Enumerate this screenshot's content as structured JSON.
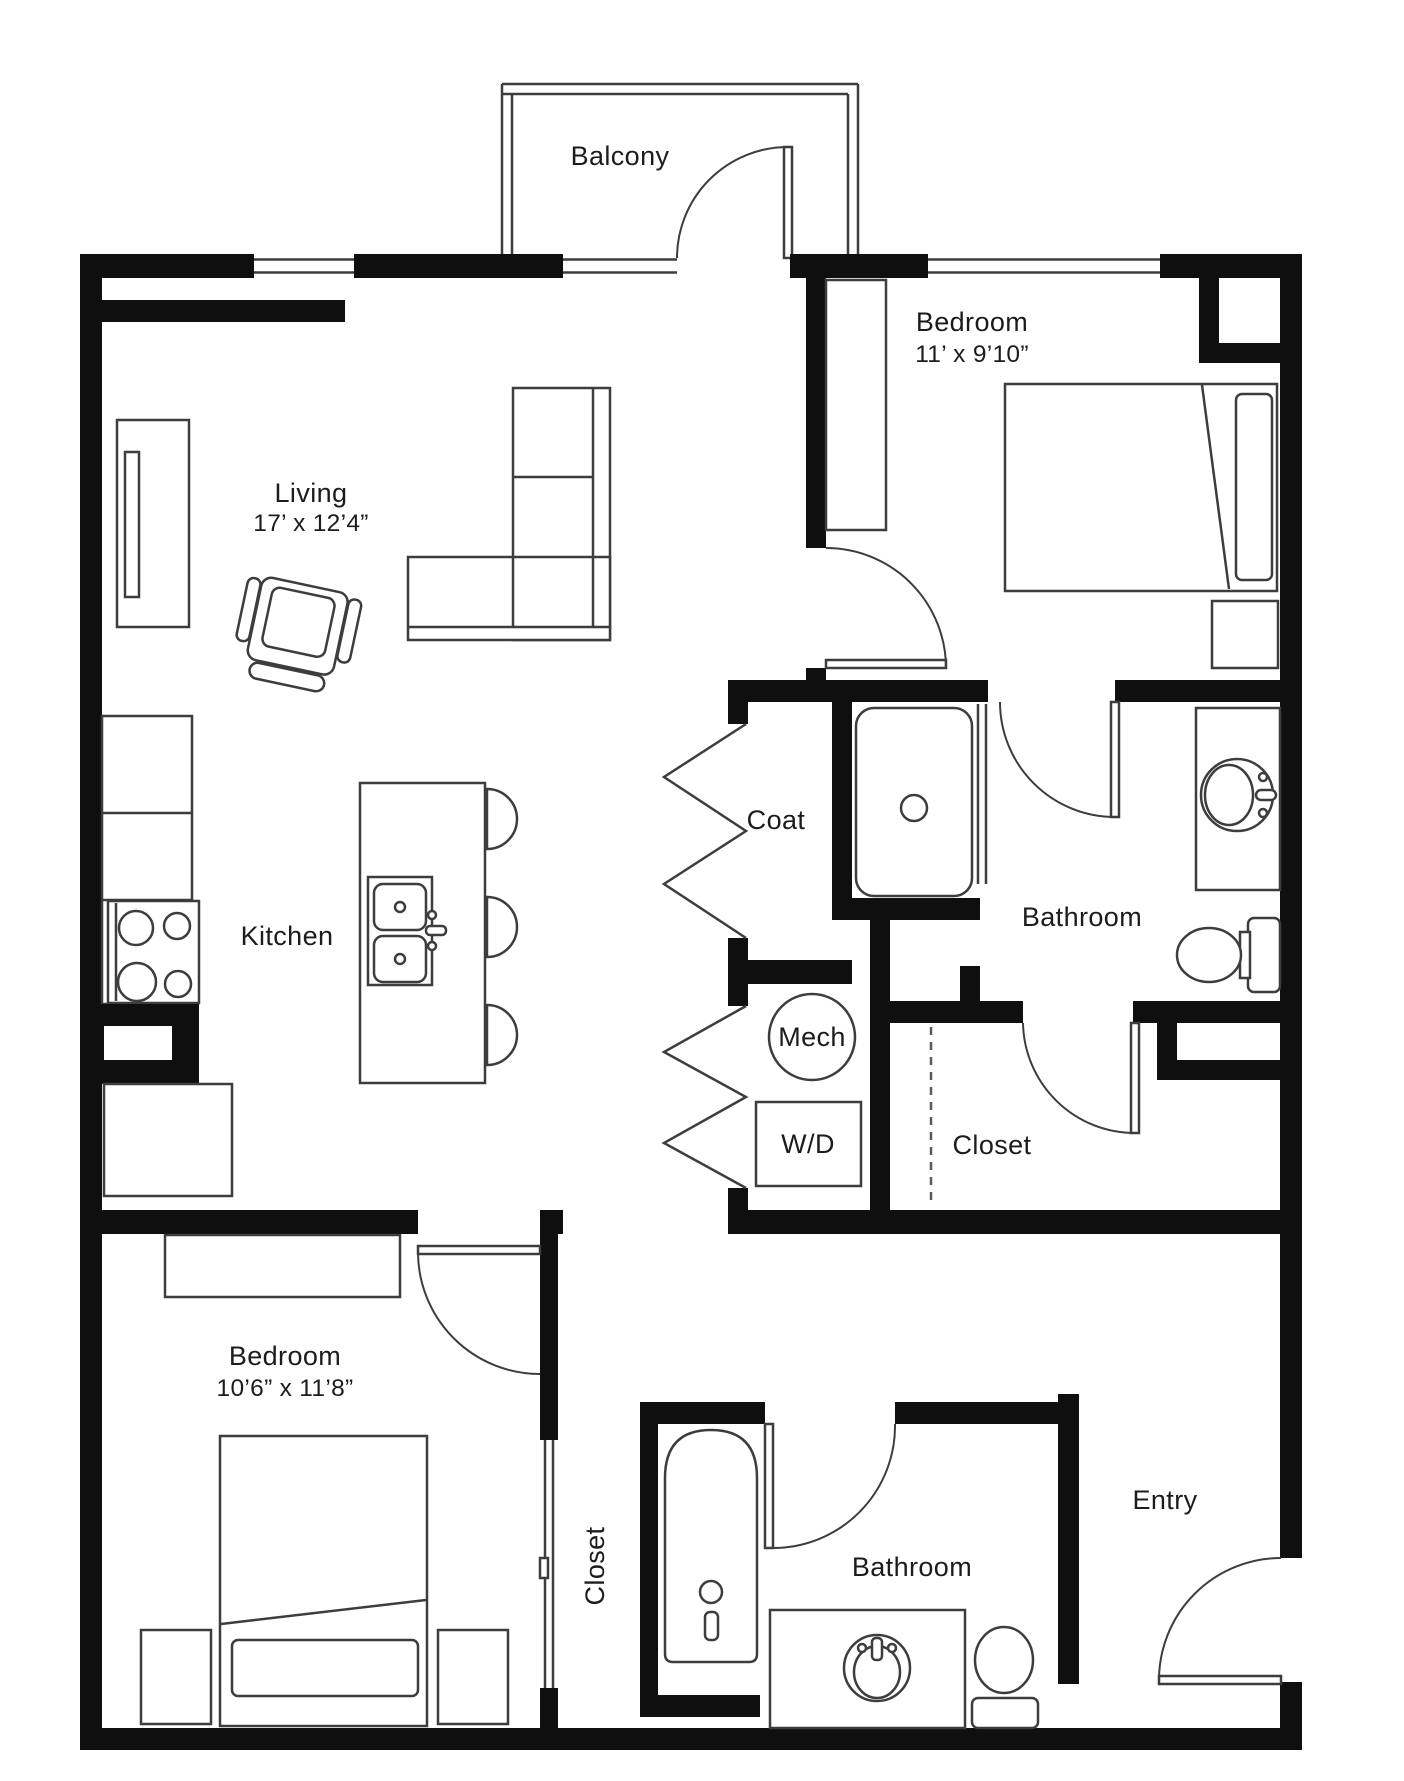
{
  "plan_title": "Two bedroom apartment floor plan",
  "colors": {
    "wall": "#0f0f0f",
    "line": "#3d3d3d",
    "background": "#ffffff",
    "text": "#1c1c1c"
  },
  "rooms": {
    "balcony": {
      "name": "Balcony"
    },
    "bedroom1": {
      "name": "Bedroom",
      "dims": "11’ x 9’10”"
    },
    "living": {
      "name": "Living",
      "dims": "17’ x 12’4”"
    },
    "coat": {
      "name": "Coat"
    },
    "bathroom1": {
      "name": "Bathroom"
    },
    "kitchen": {
      "name": "Kitchen"
    },
    "mech": {
      "name": "Mech"
    },
    "wd": {
      "name": "W/D"
    },
    "closet1": {
      "name": "Closet"
    },
    "bedroom2": {
      "name": "Bedroom",
      "dims": "10’6” x 11’8”"
    },
    "closet2": {
      "name": "Closet"
    },
    "bathroom2": {
      "name": "Bathroom"
    },
    "entry": {
      "name": "Entry"
    }
  }
}
